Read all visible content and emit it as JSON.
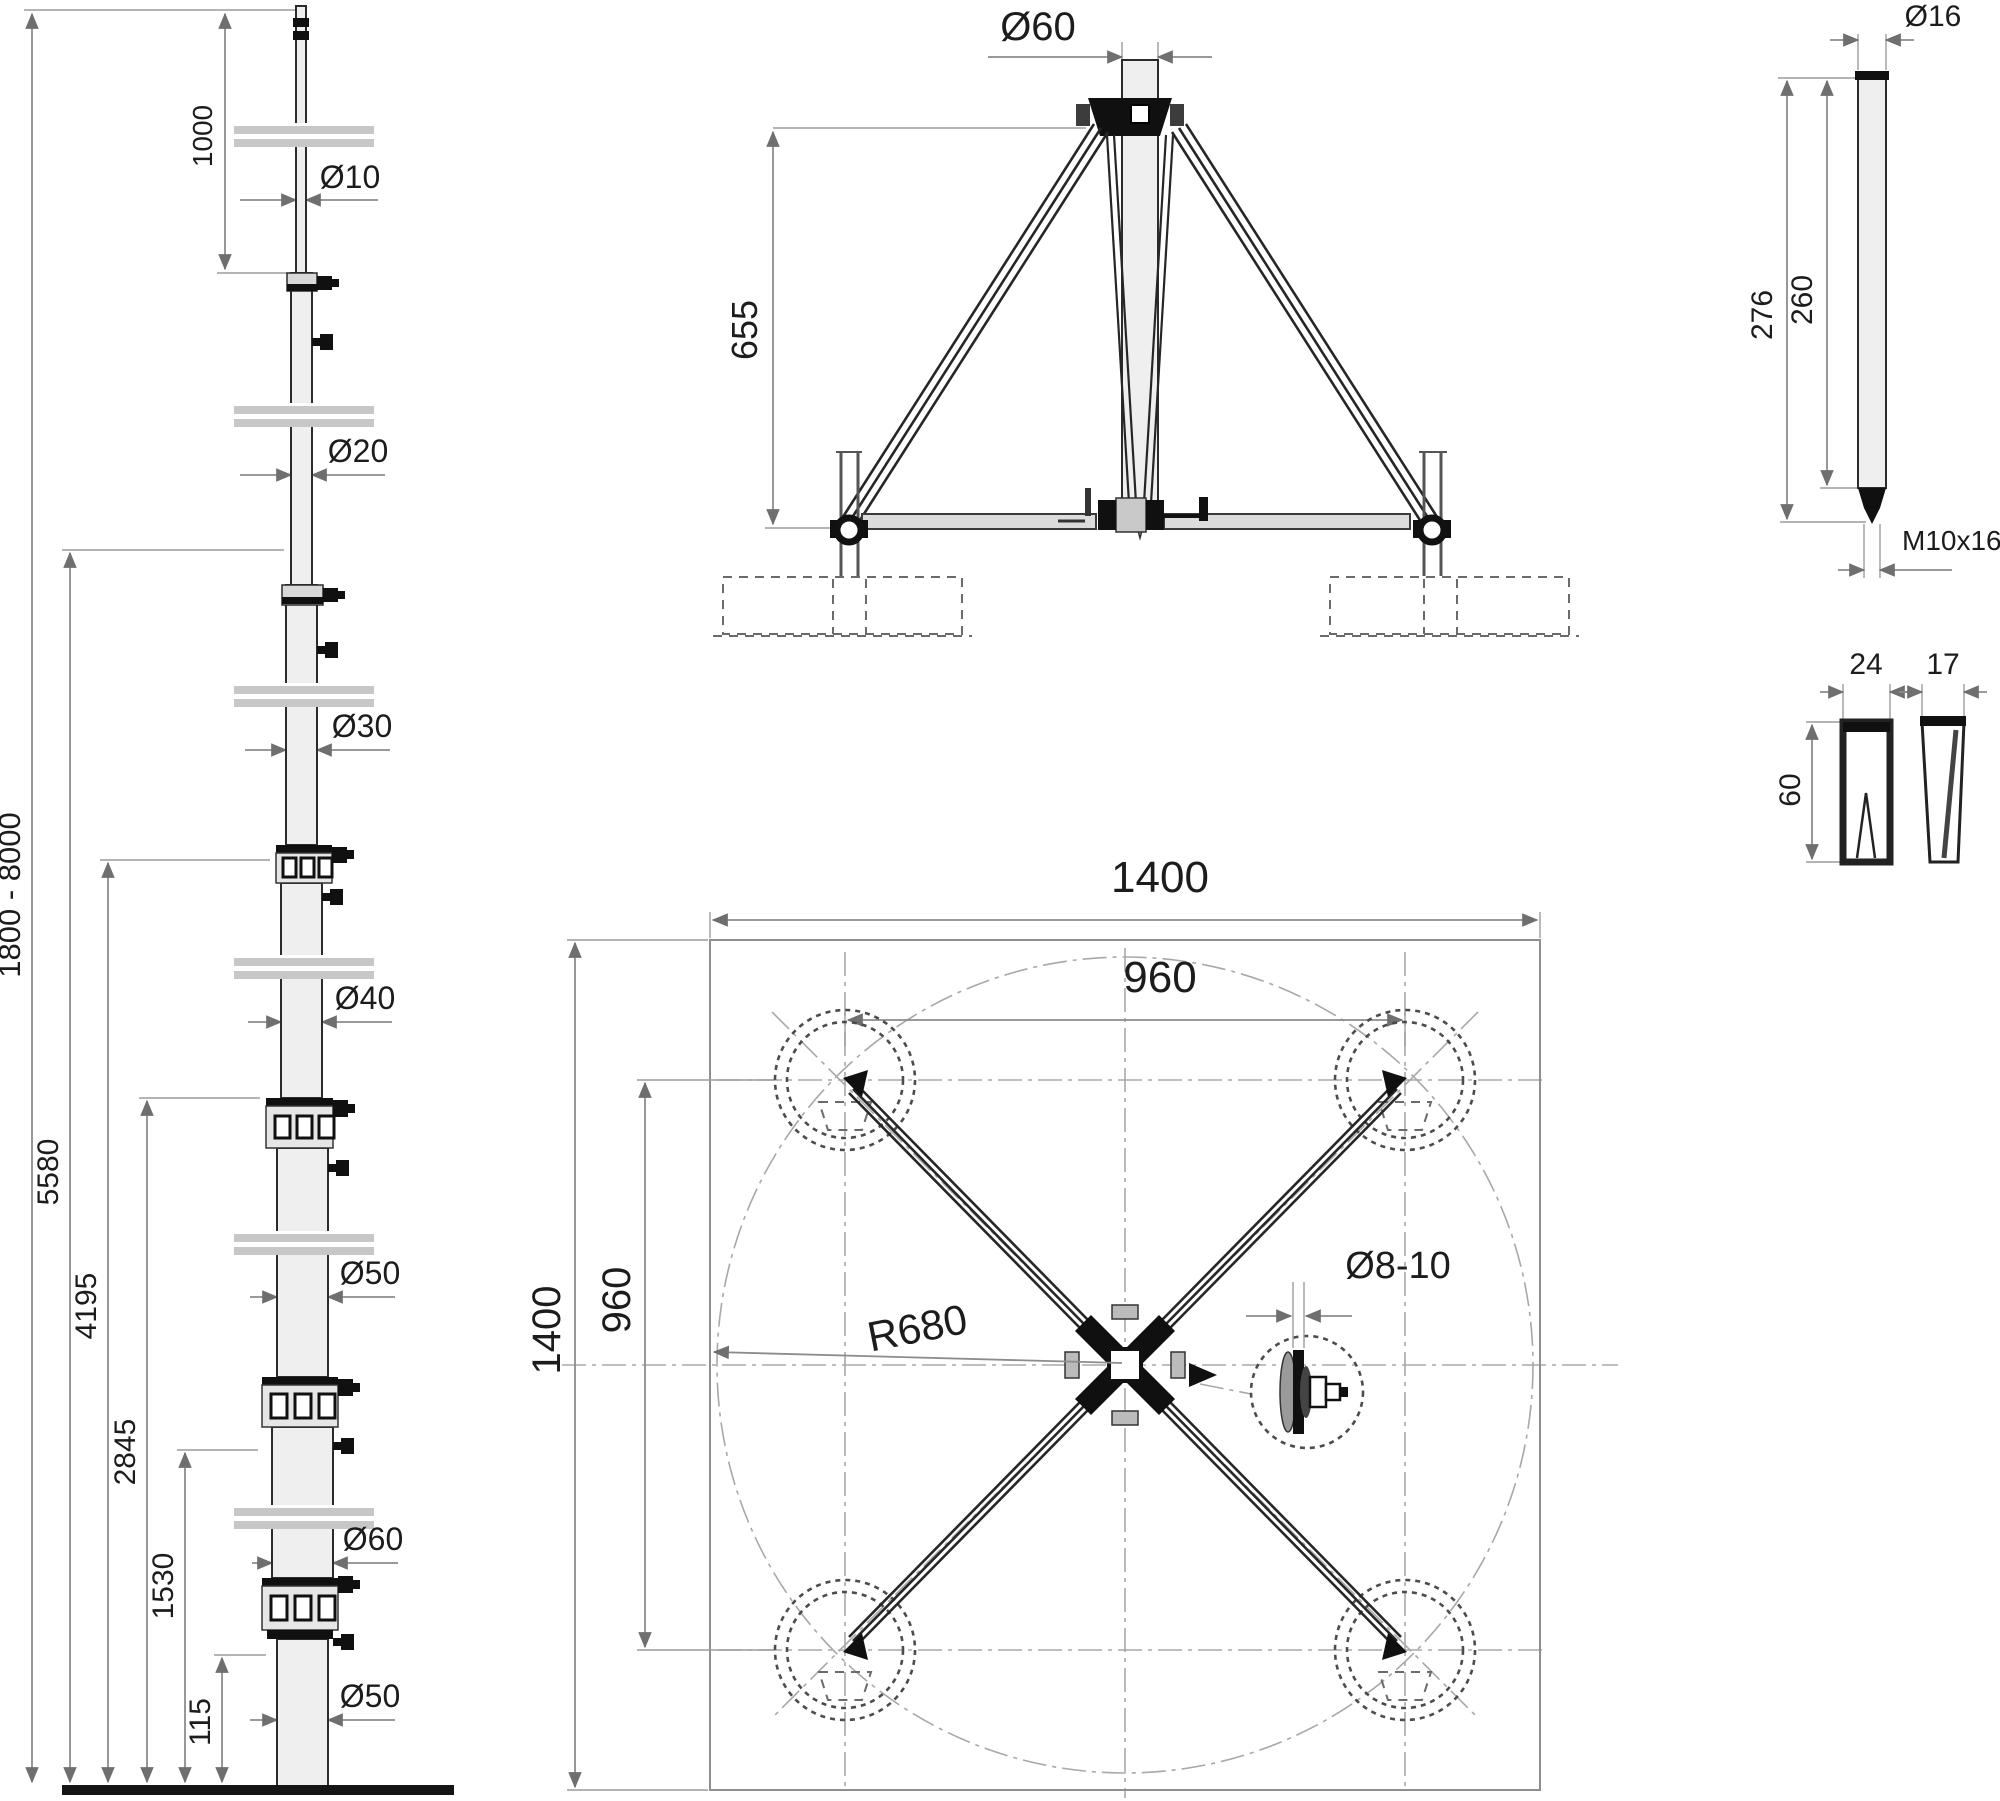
{
  "mast_elevation": {
    "tip_length": "1000",
    "dia_tip": "Ø10",
    "dia_2": "Ø20",
    "dia_3": "Ø30",
    "dia_4": "Ø40",
    "dia_5": "Ø50",
    "dia_6": "Ø60",
    "dia_base": "Ø50",
    "height_range": "1800 - 8000",
    "h_5": "5580",
    "h_4": "4195",
    "h_3": "2845",
    "h_2": "1530",
    "h_base": "115"
  },
  "front_view": {
    "top_diameter": "Ø60",
    "stand_height": "655"
  },
  "rod_detail": {
    "diameter": "Ø16",
    "total_length": "276",
    "shaft_length": "260",
    "thread": "M10x16"
  },
  "clamp_detail": {
    "channel_width": "24",
    "wedge_width": "17",
    "height": "60"
  },
  "plan_view": {
    "width": "1400",
    "bolt_spread_h": "960",
    "depth": "1400",
    "bolt_spread_v": "960",
    "radius": "R680",
    "anchor_holes": "Ø8-10"
  }
}
